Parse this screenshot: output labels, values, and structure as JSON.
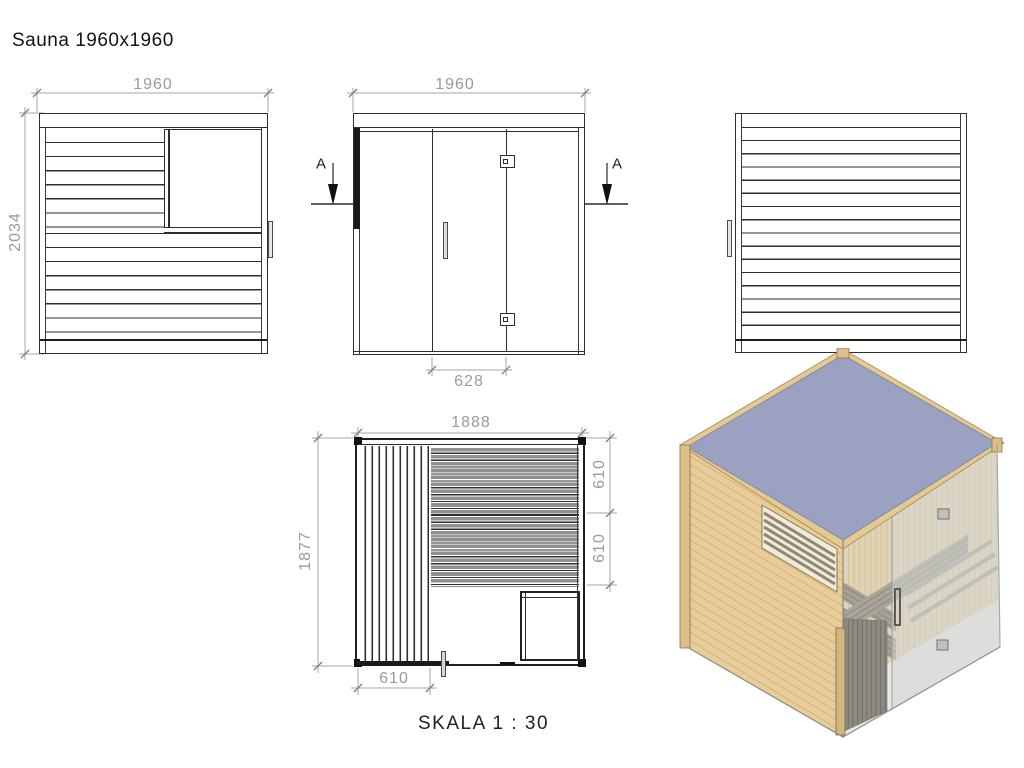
{
  "title": "Sauna 1960x1960",
  "scale_label": "SKALA 1 : 30",
  "section_label": "A",
  "dimensions": {
    "left_elevation": {
      "width_mm": "1960",
      "height_mm": "2034"
    },
    "front_elevation": {
      "width_mm": "1960",
      "door_width_mm": "628"
    },
    "plan": {
      "width_mm": "1888",
      "depth_mm": "1877",
      "bench_depth_1_mm": "610",
      "bench_depth_2_mm": "610",
      "backrest_width_mm": "610"
    }
  },
  "colors": {
    "line": "#2e2e2e",
    "dimension": "#9a9a9a",
    "wood": "#e8cd9a",
    "wood_grain": "#d2b277",
    "roof": "#9ba2c1",
    "bench": "#958d7b",
    "glass": "#ccd1d3"
  }
}
